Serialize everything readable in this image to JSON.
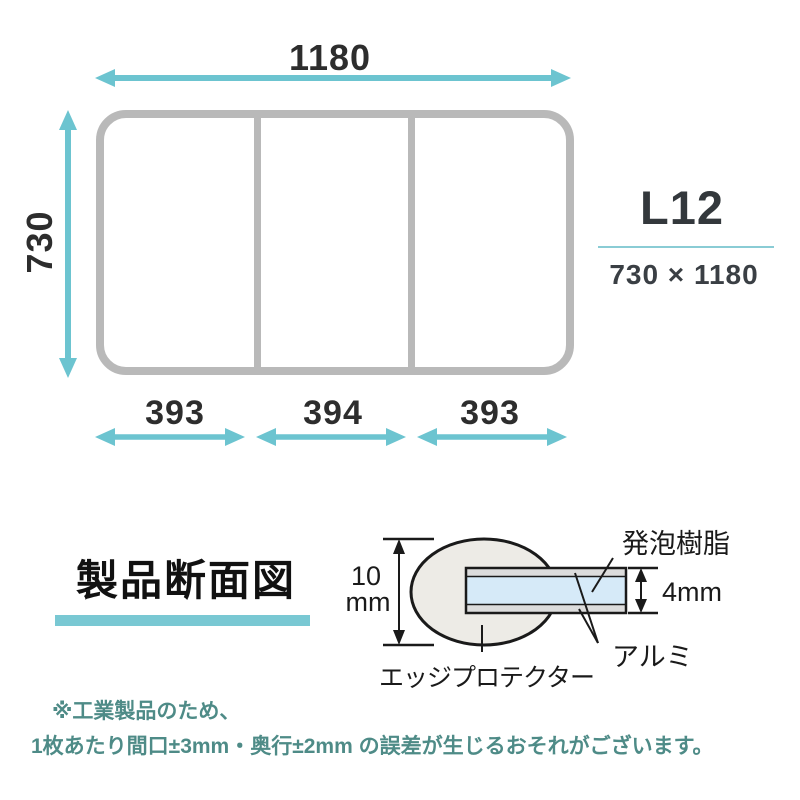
{
  "colors": {
    "teal_arrow": "#6cc4d0",
    "teal_title_bar": "#79c8d3",
    "teal_rule": "#8accd5",
    "lid_outline_gray": "#b9b9b9",
    "dimension_text": "#2d2d2d",
    "footer_text": "#4e8b87",
    "foam_fill": "#d6eaf8",
    "aluminum_fill": "#dcdcdc",
    "edge_protector_fill": "#edebe6"
  },
  "top_diagram": {
    "width_label": "1180",
    "height_label": "730",
    "panel_labels": [
      "393",
      "394",
      "393"
    ]
  },
  "model_block": {
    "code": "L12",
    "dimensions": "730 × 1180"
  },
  "cross_section": {
    "title": "製品断面図",
    "total_thickness_value": "10",
    "total_thickness_unit": "mm",
    "foam_label": "発泡樹脂",
    "core_thickness": "4mm",
    "aluminum_label": "アルミ",
    "edge_protector_label": "エッジプロテクター"
  },
  "footer": {
    "line1": "※工業製品のため、",
    "line2": "1枚あたり間口±3mm・奥行±2mm の誤差が生じるおそれがございます。"
  }
}
